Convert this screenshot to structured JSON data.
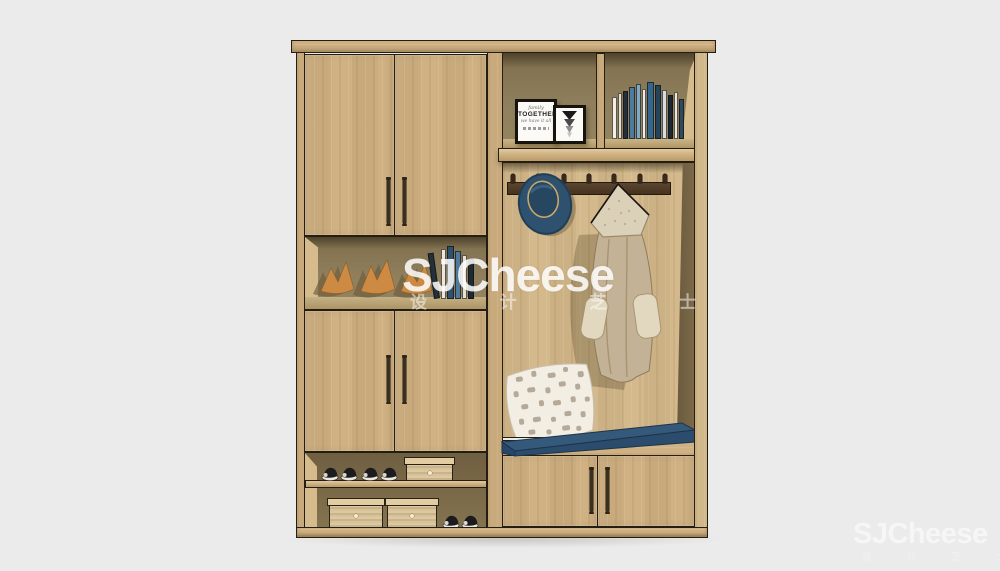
{
  "watermark": {
    "center": {
      "text": "SJCheese",
      "subtext": "设 计 芝 士"
    },
    "corner": {
      "text": "SJCheese",
      "subtext": "设 计 芝 士"
    }
  },
  "frames": {
    "together_frame": {
      "line1": "family",
      "line2": "TOGETHER",
      "line3": "we have it all"
    }
  },
  "colors": {
    "bg": "#ebebeb",
    "wood": "#cfb183",
    "wood-light": "#dcc094",
    "wood-pale": "#d6bc8d",
    "wood-dark": "#b2945f",
    "outline": "#241d12",
    "interior": "#8a7a58",
    "interior-dark": "#6b5a3e",
    "rail": "#4f3c27",
    "navy": "#2e5170",
    "navy-light": "#35597b",
    "navy-dark": "#2b4c6c",
    "coat": "#c3b296",
    "coat-light": "#dbd0b8",
    "pillow": "#f2eee4",
    "pillow-dot": "#b5aa99",
    "orange": "#cc8a42",
    "frame-black": "#17130d"
  },
  "books": {
    "top_shelf": [
      {
        "c": "#f3efe6",
        "w": 5,
        "h": 42
      },
      {
        "c": "#e7e1d2",
        "w": 4,
        "h": 46
      },
      {
        "c": "#22303c",
        "w": 5,
        "h": 48
      },
      {
        "c": "#4d7ba0",
        "w": 6,
        "h": 52
      },
      {
        "c": "#7fa8c4",
        "w": 5,
        "h": 55
      },
      {
        "c": "#f1ede4",
        "w": 4,
        "h": 50
      },
      {
        "c": "#35678e",
        "w": 7,
        "h": 57
      },
      {
        "c": "#24435c",
        "w": 6,
        "h": 54
      },
      {
        "c": "#d7dde0",
        "w": 5,
        "h": 49
      },
      {
        "c": "#1b2630",
        "w": 5,
        "h": 44
      },
      {
        "c": "#efe9db",
        "w": 4,
        "h": 47
      },
      {
        "c": "#2e4a60",
        "w": 5,
        "h": 40
      }
    ],
    "display_shelf": [
      {
        "c": "#22303c",
        "w": 6,
        "h": 46,
        "lean": -8
      },
      {
        "c": "#ece7da",
        "w": 5,
        "h": 50
      },
      {
        "c": "#2e5170",
        "w": 7,
        "h": 53
      },
      {
        "c": "#4d7ba0",
        "w": 6,
        "h": 48
      },
      {
        "c": "#e8e2d2",
        "w": 5,
        "h": 44
      },
      {
        "c": "#1d2a36",
        "w": 6,
        "h": 40
      }
    ]
  }
}
